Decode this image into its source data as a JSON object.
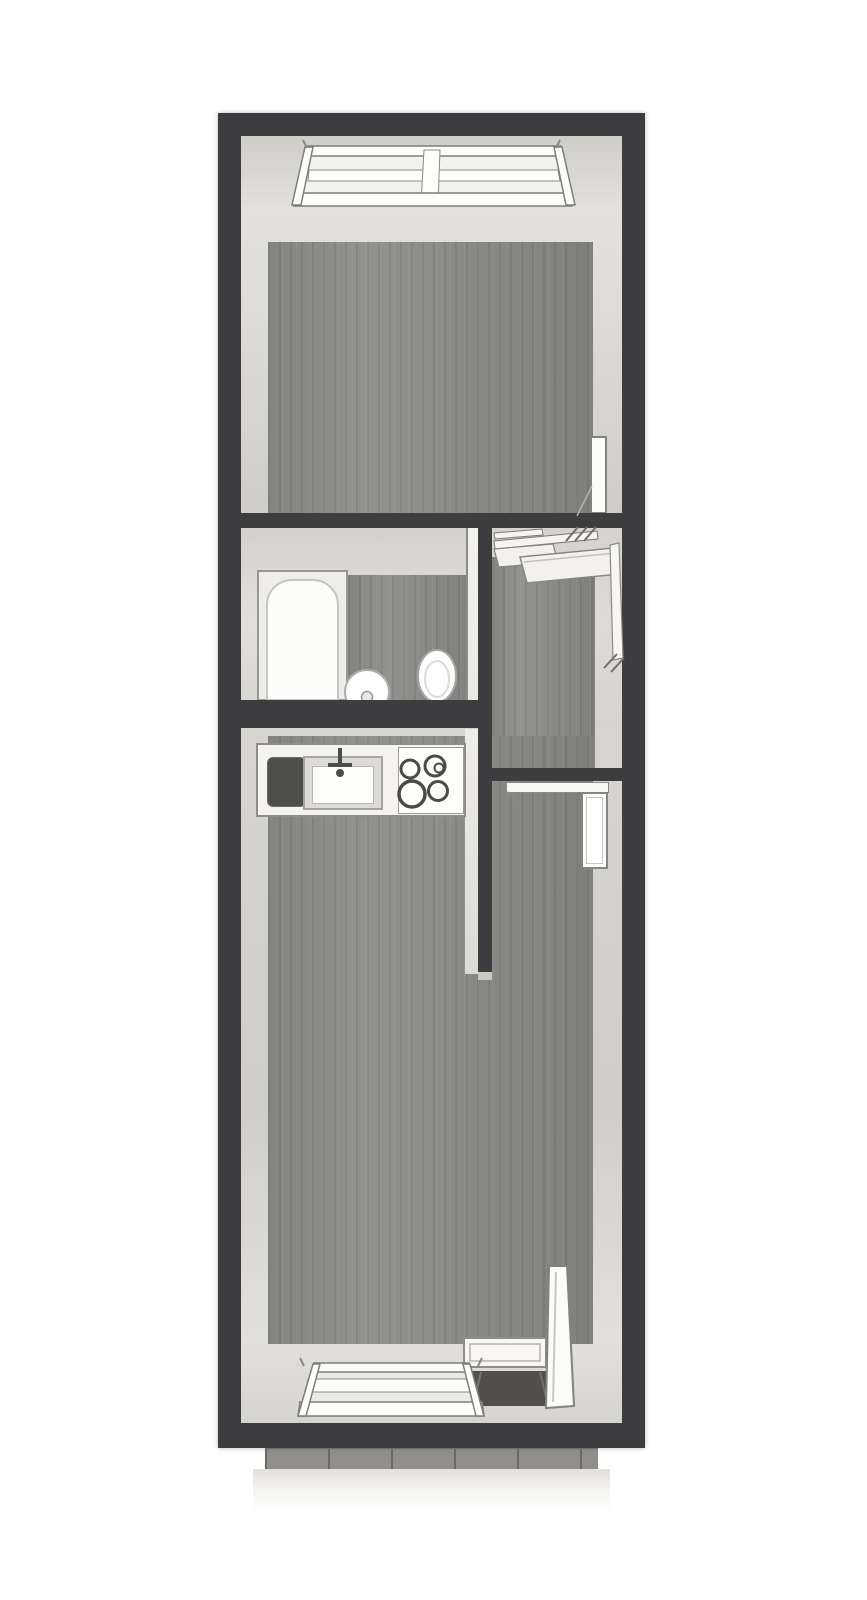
{
  "app": {
    "name": "Apartment floor plan",
    "view": "3D top-down rendering",
    "text_labels": []
  },
  "palette": {
    "page_background": "#ffffff",
    "wall_dark": "#3d3d3f",
    "wall_face_light": "#d8d6d0",
    "wall_face_bright": "#efede9",
    "floor_wood_gray": "#8c8c89",
    "fixture_white": "#fbfbfa",
    "fixture_border_gray": "#8a8987",
    "cooktop_ring": "#4a4a48",
    "sink_tray_dark": "#4e4e4c",
    "balcony_glass_dark": "#504f4d",
    "balcony_deck": "#908f8c"
  },
  "rooms": {
    "bedroom": {
      "name": "Room (top) with window and door",
      "fixtures": [
        "window",
        "open door leaf"
      ]
    },
    "bathroom": {
      "name": "Bathroom",
      "fixtures": [
        "bathtub",
        "washbasin",
        "toilet",
        "door leaf"
      ]
    },
    "hallway": {
      "name": "Hallway / entry",
      "fixtures": [
        "open wardrobe shelves"
      ]
    },
    "living": {
      "name": "Living room with kitchenette",
      "fixtures": [
        "kitchen counter",
        "sink with faucet",
        "4-burner cooktop",
        "open interior door",
        "balcony door",
        "window"
      ]
    },
    "balcony": {
      "name": "Balcony strip below plan",
      "fixtures": [
        "wood decking"
      ]
    }
  },
  "structure": {
    "outer_wall": "thick dark perimeter wall",
    "interior_walls": [
      "wall under top room",
      "bathroom bottom wall",
      "bathroom/hallway divider",
      "kitchen partition wall",
      "hallway bottom wall"
    ]
  }
}
